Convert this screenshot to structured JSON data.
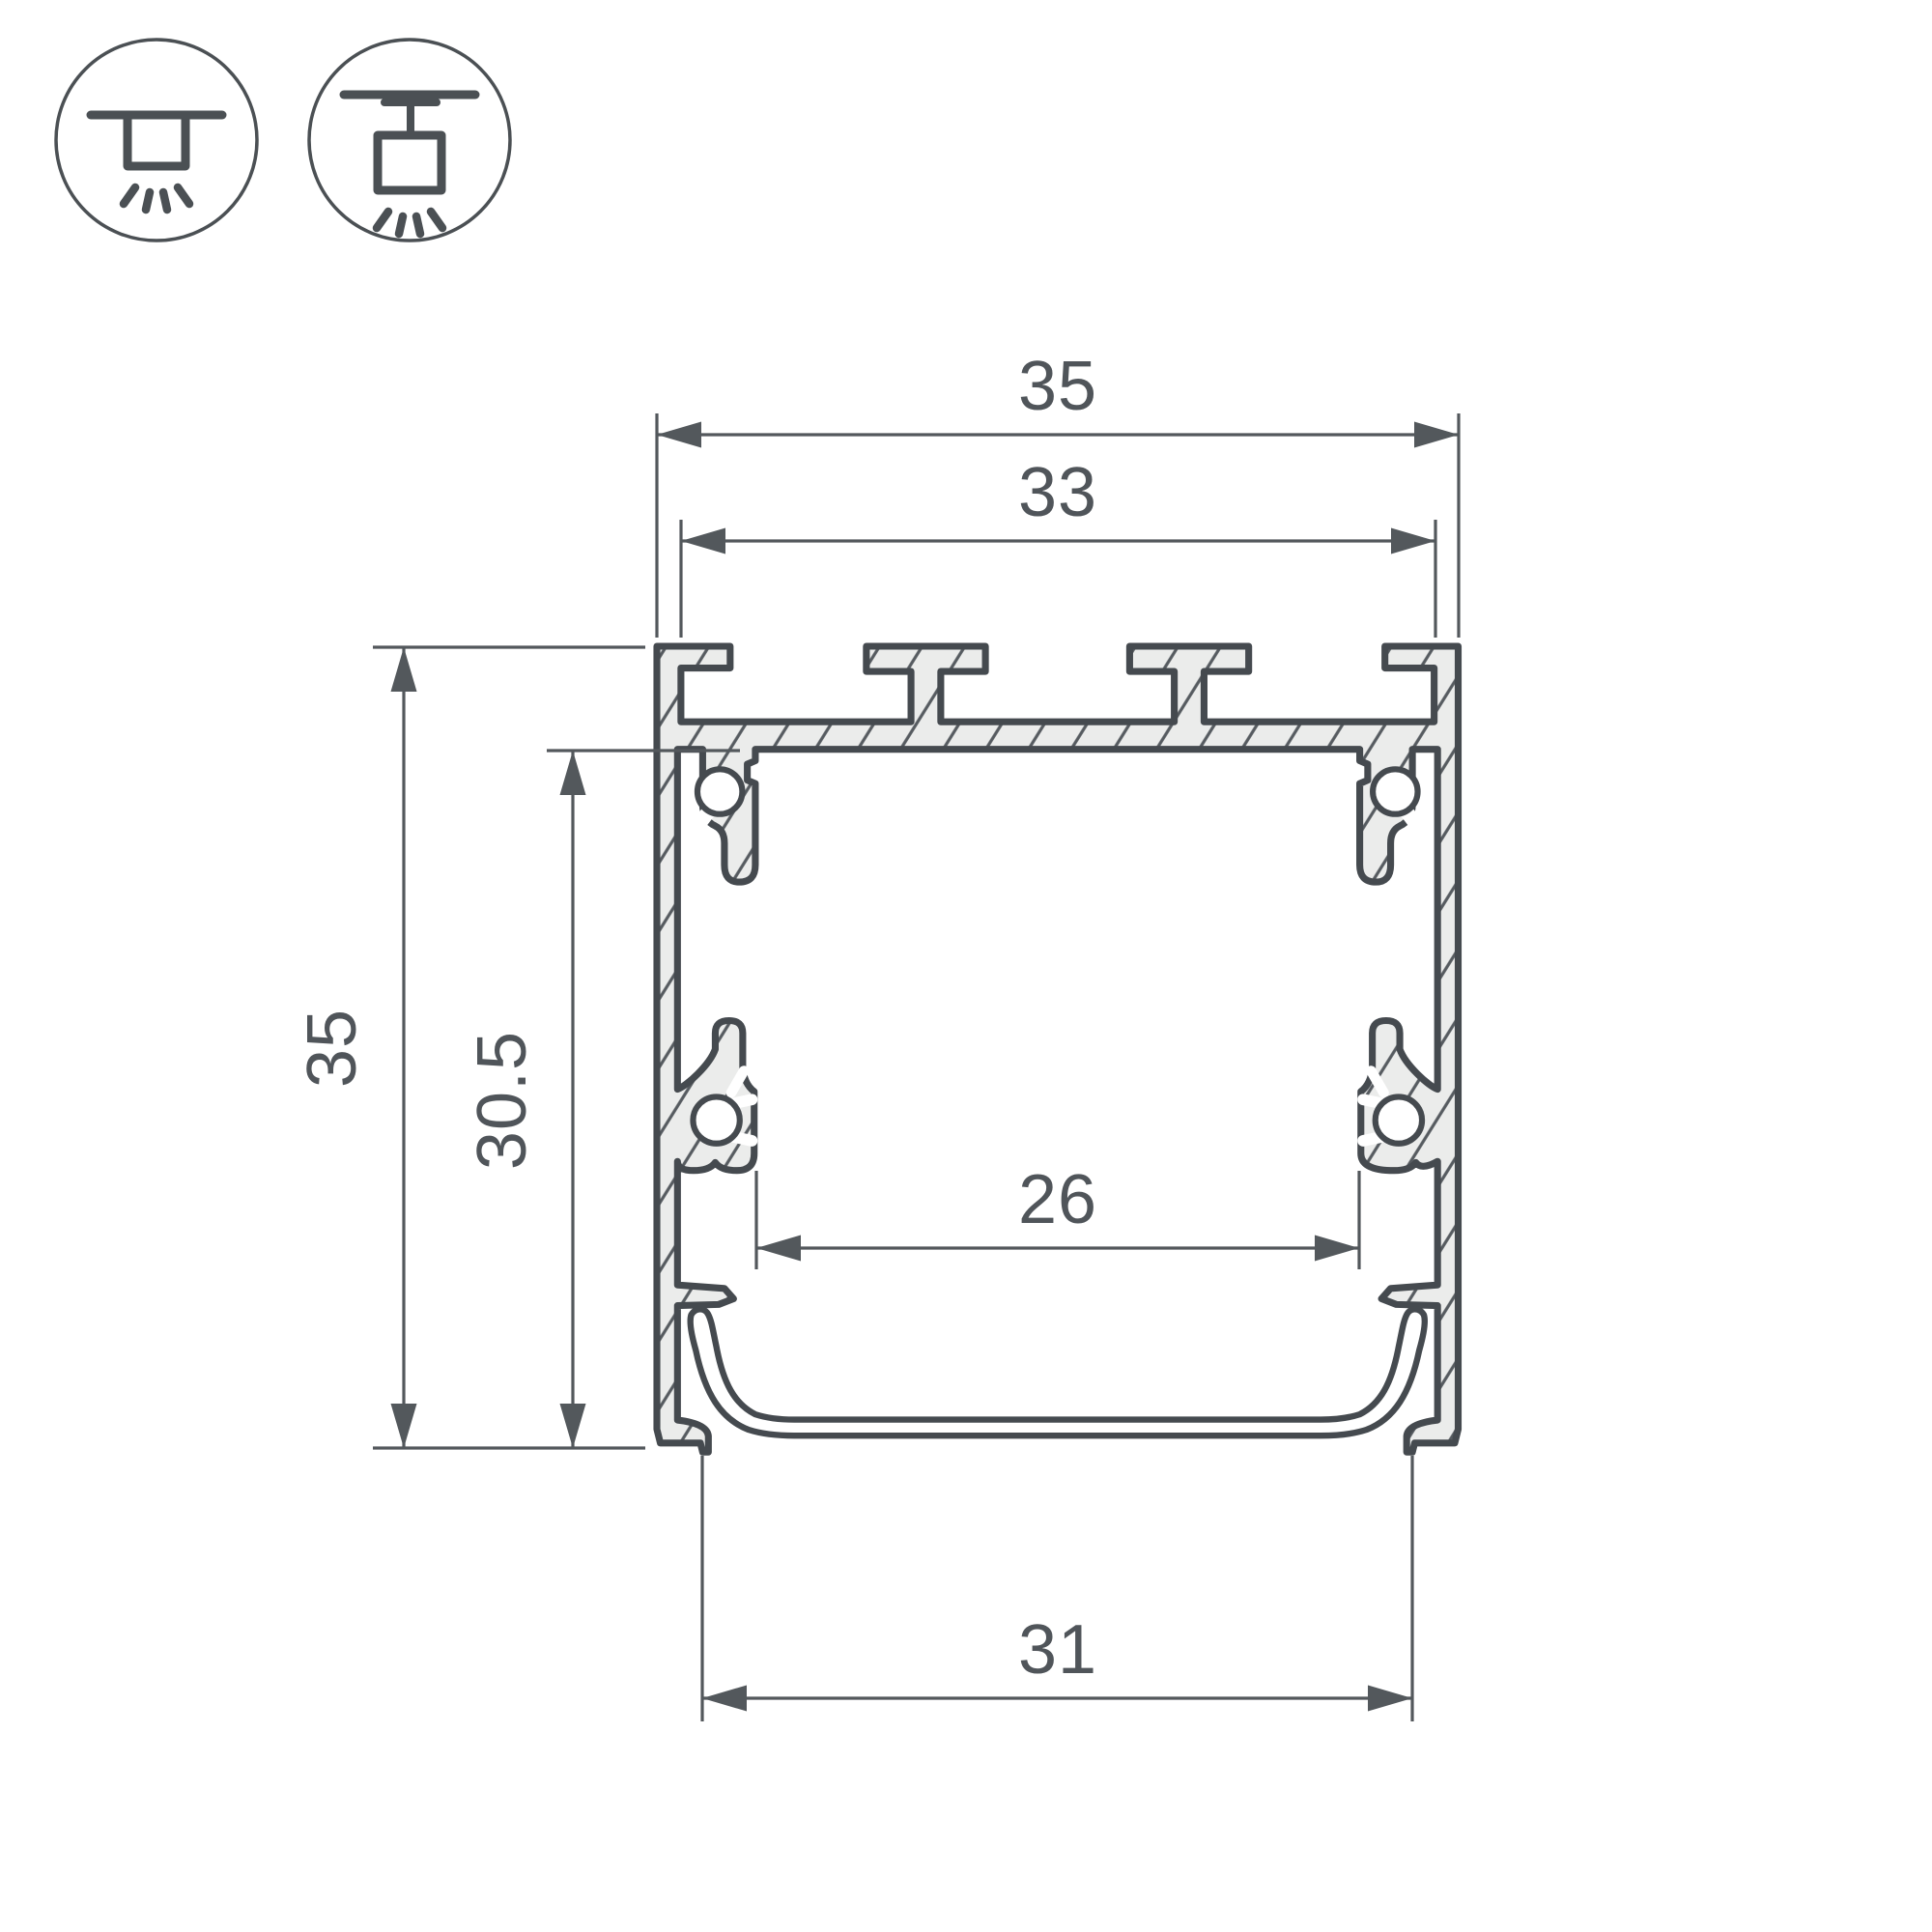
{
  "drawing": {
    "type": "profile-cross-section-dimension-drawing",
    "dimensions": {
      "top_width": "35",
      "top_inner_width": "33",
      "height": "35",
      "inner_height": "30.5",
      "inner_width": "26",
      "bottom_width": "31"
    },
    "icons": [
      {
        "name": "flush-ceiling-mount-icon",
        "meaning": "surface ceiling mount, light downward"
      },
      {
        "name": "bracket-surface-mount-icon",
        "meaning": "surface mount with bracket, light downward"
      }
    ],
    "colors": {
      "background": "#ffffff",
      "outline": "#454a4f",
      "dimension_lines": "#53585c",
      "metal_fill": "#ebeceb",
      "hatch": "#565b60",
      "icon_stroke": "#4b5054"
    }
  }
}
